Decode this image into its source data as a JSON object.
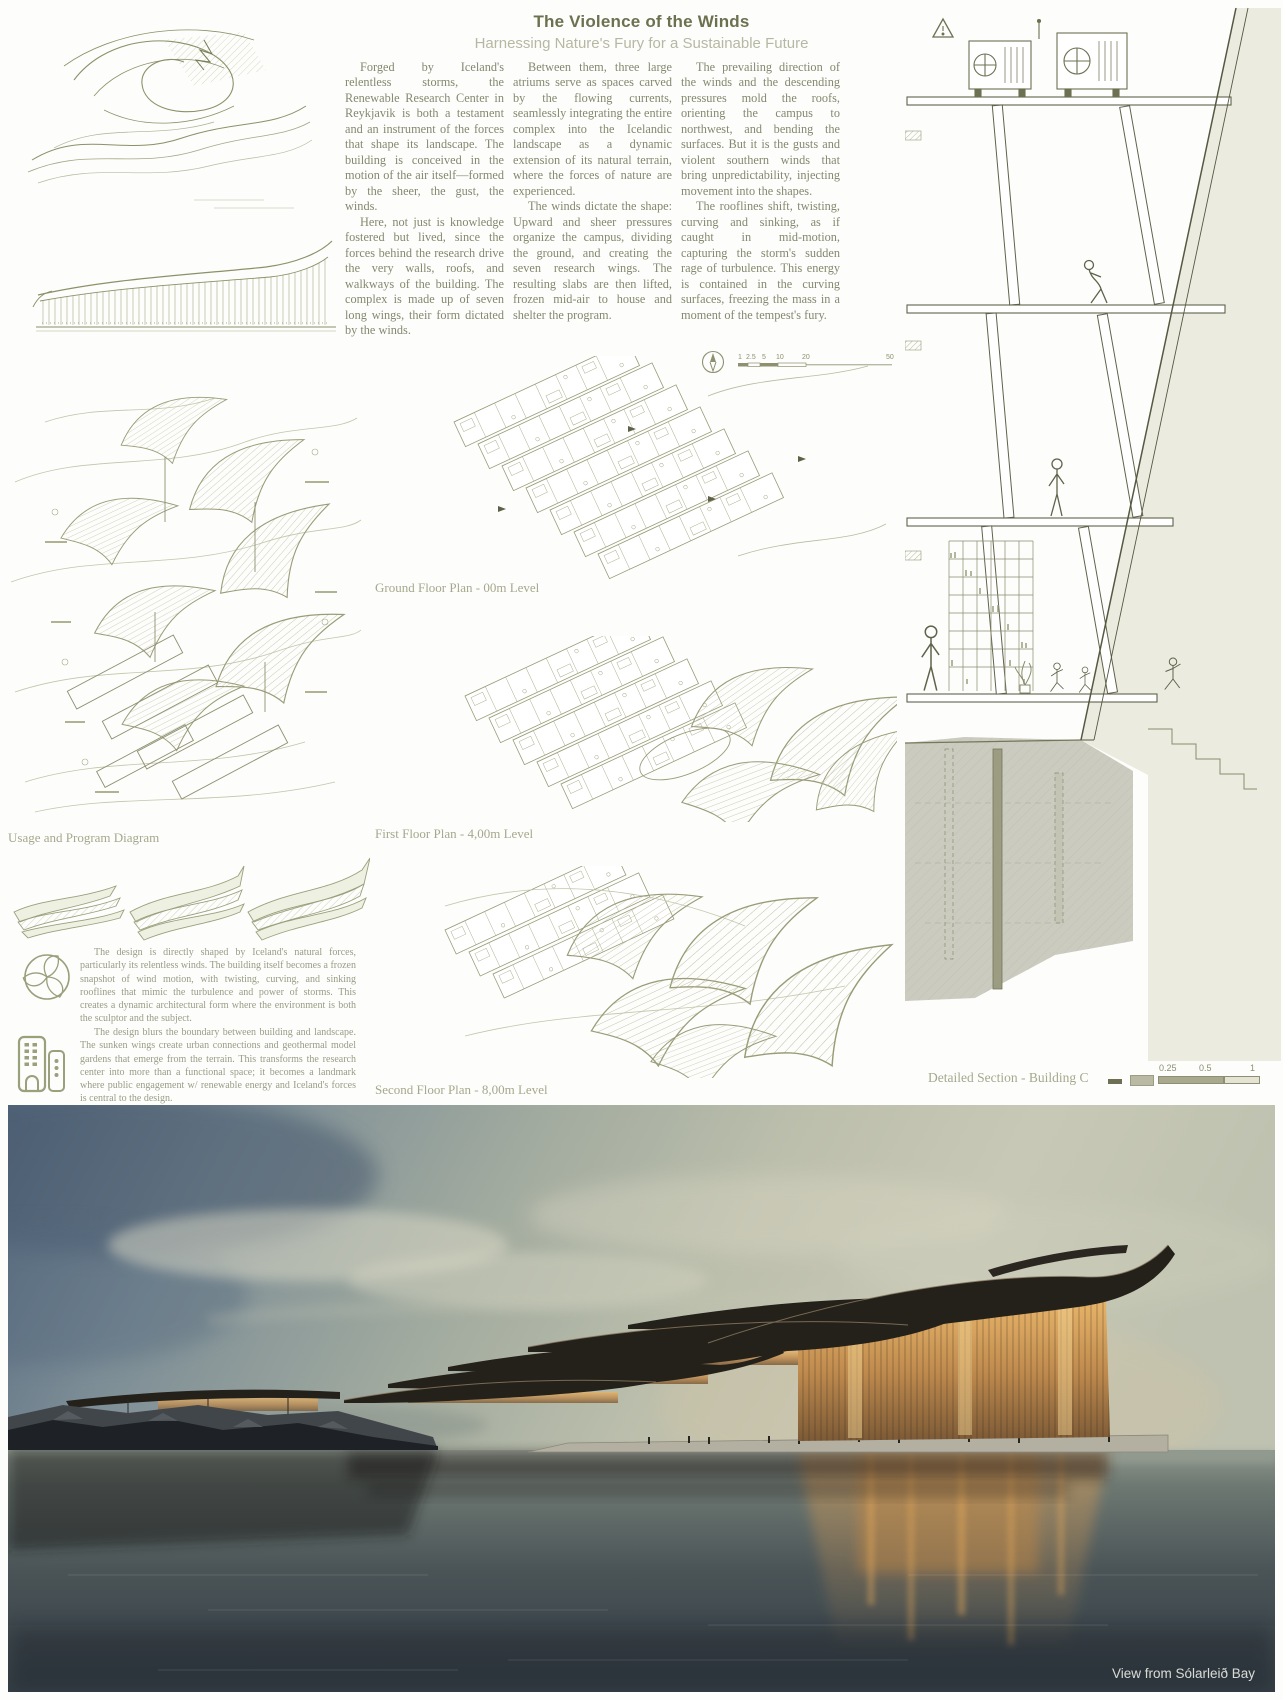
{
  "header": {
    "title": "The Violence of the Winds",
    "subtitle": "Harnessing Nature's Fury for a Sustainable Future"
  },
  "intro_columns": [
    {
      "paragraphs": [
        "Forged by Iceland's relentless storms, the Renewable Research Center in Reykjavik is both a testament and an instrument of the forces that shape its landscape. The building is conceived in the motion of the air itself—formed by the sheer, the gust, the winds.",
        "Here, not just is knowledge fostered but lived, since the forces behind the research drive the very walls, roofs, and walkways of the building. The complex is made up of seven long wings, their form dictated by the winds."
      ]
    },
    {
      "paragraphs": [
        "Between them, three large atriums serve as spaces carved by the flowing currents, seamlessly integrating the entire complex into the Icelandic landscape as a dynamic extension of its natural terrain, where the forces of nature are experienced.",
        "The winds dictate the shape: Upward and sheer pressures organize the campus, dividing the ground, and creating the seven research wings. The resulting slabs are then lifted, frozen mid-air to house and shelter the program."
      ]
    },
    {
      "paragraphs": [
        "The prevailing direction of the winds and the descending pressures mold the roofs, orienting the campus to northwest, and bending the surfaces. But it is the gusts and violent southern winds that bring unpredictability, injecting movement into the shapes.",
        "The rooflines shift, twisting, curving and sinking, as if caught in mid-motion, capturing the storm's sudden rage of turbulence. This energy is contained in the curving surfaces, freezing the mass in a moment of the tempest's fury."
      ]
    }
  ],
  "left_panel": {
    "usage_caption": "Usage and Program Diagram",
    "paragraph_eco": "The design is directly shaped by Iceland's natural forces, particularly its relentless winds. The building itself becomes a frozen snapshot of wind motion, with twisting, curving, and sinking rooflines that mimic the turbulence and power of storms. This creates a dynamic architectural form where the environment is both the sculptor and the subject.",
    "paragraph_urban": "The design blurs the boundary between building and landscape. The sunken wings create urban connections and geothermal model gardens that emerge from the terrain. This transforms the research center into more than a functional space; it becomes a landmark where public engagement w/ renewable energy and Iceland's forces is central to the design.",
    "icons": [
      "wind-leaf-icon",
      "buildings-icon"
    ]
  },
  "plans": {
    "icons": [
      "north-compass-icon"
    ],
    "scale_labels": [
      "1",
      "2.5",
      "5",
      "10",
      "20",
      "50"
    ],
    "items": [
      {
        "caption": "Ground Floor Plan - 00m Level"
      },
      {
        "caption": "First Floor Plan - 4,00m Level"
      },
      {
        "caption": "Second Floor Plan - 8,00m Level"
      }
    ]
  },
  "section_panel": {
    "caption": "Detailed Section - Building C",
    "scale_labels": [
      "0.25",
      "0.5",
      "1"
    ]
  },
  "render_view": {
    "caption": "View from Sólarleið Bay"
  },
  "colors": {
    "drawing_olive": "#8e9070",
    "title": "#6d7150",
    "subtitle": "#b7b8a3",
    "body_text": "#85886f",
    "caption": "#a6a88d",
    "photo_sky_left": "#54677c",
    "photo_water": "#343f46",
    "photo_glass_glow": "#d9a05e"
  }
}
